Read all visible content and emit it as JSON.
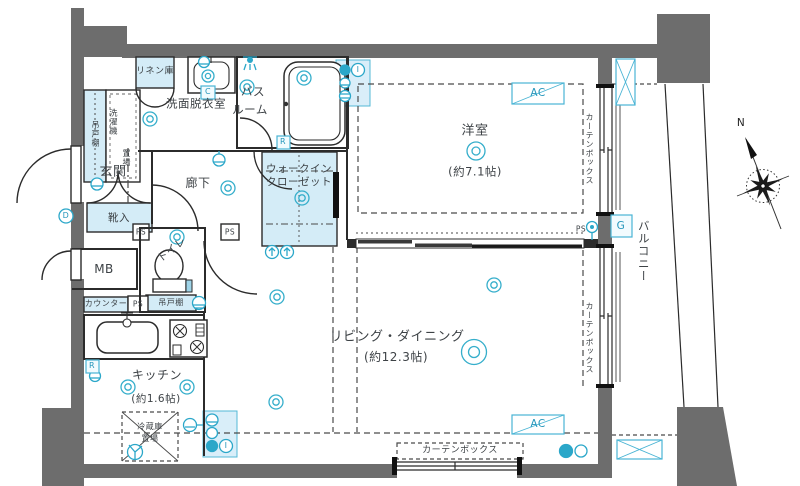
{
  "rooms": {
    "genkan": "玄関",
    "hall": "廊下",
    "washroom": "洗面脱衣室",
    "bath_line1": "バス",
    "bath_line2": "ルーム",
    "linen": "リネン庫",
    "hanging_cupboard": "吊戸棚",
    "washer_line1": "洗濯機",
    "washer_line2": "置場",
    "shoe_cabinet": "靴入",
    "toilet": "トイレ",
    "meter_box": "MB",
    "counter": "カウンター",
    "kitchen": "キッチン",
    "kitchen_size": "(約1.6帖)",
    "fridge_line1": "冷蔵庫",
    "fridge_line2": "置場",
    "wic_line1": "ウォークイン",
    "wic_line2": "クローゼット",
    "western": "洋室",
    "western_size": "(約7.1帖)",
    "living": "リビング・ダイニング",
    "living_size": "(約12.3帖)",
    "balcony": "バルコニー"
  },
  "marks": {
    "ps": "PS",
    "ac": "AC",
    "g": "G",
    "c": "C",
    "r": "R",
    "d": "D",
    "i": "I",
    "n": "N",
    "curtain_box": "カーテンボックス"
  },
  "colors": {
    "wall_gray": "#6d6d6d",
    "line_black": "#2b2b2b",
    "storage_light_blue": "#d4ecf7",
    "accent_cyan": "#2ba7c9",
    "text": "#3d4246"
  }
}
